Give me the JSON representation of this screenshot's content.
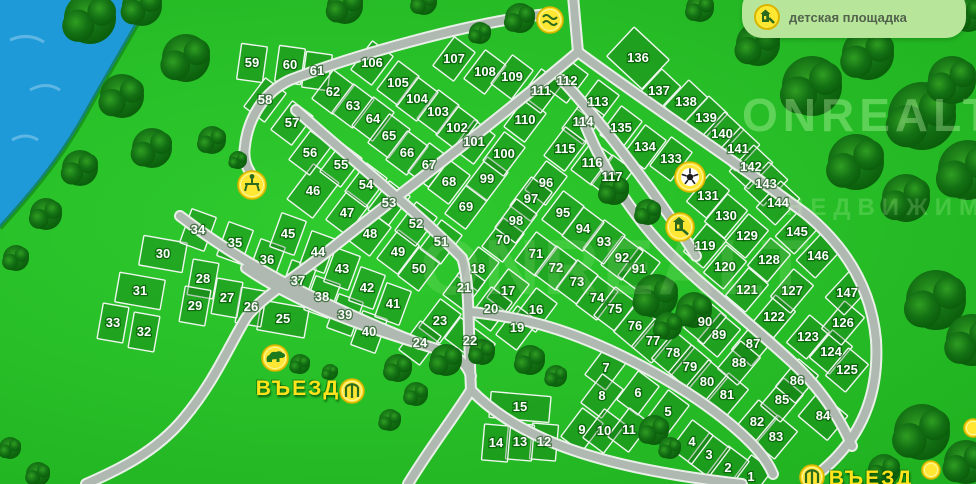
{
  "legend": {
    "label": "детская площадка",
    "icon": "playground-icon"
  },
  "watermark": {
    "line1": "ONREALT",
    "line2": "НЕДВИЖИМОСТЬ"
  },
  "entrances": [
    {
      "label": "ВЪЕЗД",
      "x": 298,
      "y": 389
    },
    {
      "label": "ВЪЕЗД",
      "x": 871,
      "y": 479
    }
  ],
  "colors": {
    "grass": "#27bd27",
    "water": "#1f9ad9",
    "road": "#b0b8b2",
    "parcel_line": "#eef6ee",
    "number_text": "#ffffff",
    "accent_yellow": "#ffe733",
    "legend_bg": "#b7e69b",
    "legend_text": "#53624c"
  },
  "icons": [
    {
      "name": "stream-icon",
      "type": "stream",
      "x": 550,
      "y": 20
    },
    {
      "name": "football-field-icon",
      "type": "football",
      "x": 690,
      "y": 177
    },
    {
      "name": "playground-map-icon",
      "type": "playground",
      "x": 680,
      "y": 227
    },
    {
      "name": "picnic-area-icon",
      "type": "picnic",
      "x": 252,
      "y": 185
    },
    {
      "name": "wildlife-icon",
      "type": "bear",
      "x": 275,
      "y": 358
    },
    {
      "name": "entrance-gate-icon",
      "type": "gate",
      "x": 352,
      "y": 391
    },
    {
      "name": "entrance-gate-icon-2",
      "type": "gate",
      "x": 812,
      "y": 477
    },
    {
      "name": "marker-icon",
      "type": "dot",
      "x": 973,
      "y": 428
    },
    {
      "name": "marker-icon-2",
      "type": "dot",
      "x": 931,
      "y": 470
    }
  ],
  "plot_labels": {
    "format": "[number, x, y]",
    "items": [
      [
        1,
        751,
        477
      ],
      [
        2,
        728,
        468
      ],
      [
        3,
        709,
        455
      ],
      [
        4,
        692,
        442
      ],
      [
        5,
        668,
        412
      ],
      [
        6,
        638,
        393
      ],
      [
        7,
        606,
        368
      ],
      [
        8,
        602,
        396
      ],
      [
        9,
        582,
        430
      ],
      [
        10,
        604,
        431
      ],
      [
        11,
        629,
        430
      ],
      [
        12,
        544,
        442
      ],
      [
        13,
        520,
        442
      ],
      [
        14,
        496,
        443
      ],
      [
        15,
        520,
        407
      ],
      [
        16,
        536,
        310
      ],
      [
        17,
        508,
        291
      ],
      [
        18,
        478,
        269
      ],
      [
        19,
        517,
        328
      ],
      [
        20,
        491,
        309
      ],
      [
        21,
        464,
        288
      ],
      [
        22,
        470,
        341
      ],
      [
        23,
        440,
        321
      ],
      [
        24,
        420,
        343
      ],
      [
        25,
        283,
        319
      ],
      [
        26,
        251,
        307
      ],
      [
        27,
        227,
        298
      ],
      [
        28,
        203,
        279
      ],
      [
        29,
        195,
        306
      ],
      [
        30,
        163,
        254
      ],
      [
        31,
        140,
        291
      ],
      [
        32,
        144,
        332
      ],
      [
        33,
        113,
        323
      ],
      [
        34,
        198,
        230
      ],
      [
        35,
        235,
        243
      ],
      [
        36,
        267,
        260
      ],
      [
        37,
        298,
        281
      ],
      [
        38,
        322,
        297
      ],
      [
        39,
        345,
        315
      ],
      [
        40,
        369,
        332
      ],
      [
        41,
        393,
        304
      ],
      [
        42,
        367,
        288
      ],
      [
        43,
        342,
        269
      ],
      [
        44,
        318,
        252
      ],
      [
        45,
        288,
        234
      ],
      [
        46,
        313,
        191
      ],
      [
        47,
        347,
        213
      ],
      [
        48,
        370,
        234
      ],
      [
        49,
        398,
        252
      ],
      [
        50,
        419,
        269
      ],
      [
        51,
        441,
        242
      ],
      [
        52,
        416,
        224
      ],
      [
        53,
        389,
        203
      ],
      [
        54,
        366,
        185
      ],
      [
        55,
        341,
        165
      ],
      [
        56,
        310,
        153
      ],
      [
        57,
        292,
        123
      ],
      [
        58,
        265,
        100
      ],
      [
        59,
        252,
        63
      ],
      [
        60,
        290,
        65
      ],
      [
        61,
        317,
        71
      ],
      [
        62,
        333,
        92
      ],
      [
        63,
        353,
        106
      ],
      [
        64,
        373,
        119
      ],
      [
        65,
        389,
        136
      ],
      [
        66,
        407,
        153
      ],
      [
        67,
        429,
        165
      ],
      [
        68,
        449,
        182
      ],
      [
        69,
        466,
        207
      ],
      [
        70,
        503,
        240
      ],
      [
        71,
        536,
        254
      ],
      [
        72,
        556,
        268
      ],
      [
        73,
        577,
        282
      ],
      [
        74,
        597,
        298
      ],
      [
        75,
        615,
        309
      ],
      [
        76,
        635,
        326
      ],
      [
        77,
        653,
        341
      ],
      [
        78,
        673,
        353
      ],
      [
        79,
        690,
        367
      ],
      [
        80,
        707,
        382
      ],
      [
        81,
        727,
        395
      ],
      [
        82,
        757,
        422
      ],
      [
        83,
        776,
        437
      ],
      [
        84,
        823,
        416
      ],
      [
        85,
        782,
        400
      ],
      [
        86,
        797,
        381
      ],
      [
        87,
        753,
        344
      ],
      [
        88,
        739,
        363
      ],
      [
        89,
        719,
        335
      ],
      [
        90,
        705,
        322
      ],
      [
        91,
        639,
        269
      ],
      [
        92,
        622,
        258
      ],
      [
        93,
        604,
        242
      ],
      [
        94,
        583,
        229
      ],
      [
        95,
        563,
        213
      ],
      [
        96,
        546,
        183
      ],
      [
        97,
        531,
        199
      ],
      [
        98,
        516,
        221
      ],
      [
        99,
        487,
        179
      ],
      [
        100,
        504,
        154
      ],
      [
        101,
        474,
        142
      ],
      [
        102,
        457,
        128
      ],
      [
        103,
        438,
        112
      ],
      [
        104,
        417,
        99
      ],
      [
        105,
        398,
        83
      ],
      [
        106,
        372,
        63
      ],
      [
        107,
        454,
        59
      ],
      [
        108,
        485,
        72
      ],
      [
        109,
        512,
        77
      ],
      [
        110,
        525,
        120
      ],
      [
        111,
        541,
        91
      ],
      [
        112,
        567,
        81
      ],
      [
        113,
        598,
        102
      ],
      [
        114,
        583,
        122
      ],
      [
        115,
        565,
        149
      ],
      [
        116,
        592,
        163
      ],
      [
        117,
        612,
        177
      ],
      [
        119,
        705,
        246
      ],
      [
        120,
        725,
        267
      ],
      [
        121,
        747,
        290
      ],
      [
        122,
        774,
        317
      ],
      [
        123,
        808,
        337
      ],
      [
        124,
        831,
        352
      ],
      [
        125,
        847,
        370
      ],
      [
        126,
        843,
        323
      ],
      [
        127,
        792,
        291
      ],
      [
        128,
        769,
        260
      ],
      [
        129,
        747,
        236
      ],
      [
        130,
        726,
        216
      ],
      [
        131,
        708,
        196
      ],
      [
        133,
        671,
        159
      ],
      [
        134,
        645,
        147
      ],
      [
        135,
        621,
        128
      ],
      [
        136,
        638,
        58
      ],
      [
        137,
        659,
        91
      ],
      [
        138,
        686,
        102
      ],
      [
        139,
        706,
        118
      ],
      [
        140,
        722,
        134
      ],
      [
        141,
        738,
        149
      ],
      [
        142,
        751,
        167
      ],
      [
        143,
        766,
        184
      ],
      [
        144,
        778,
        203
      ],
      [
        145,
        797,
        232
      ],
      [
        146,
        818,
        256
      ],
      [
        147,
        847,
        293
      ]
    ]
  }
}
